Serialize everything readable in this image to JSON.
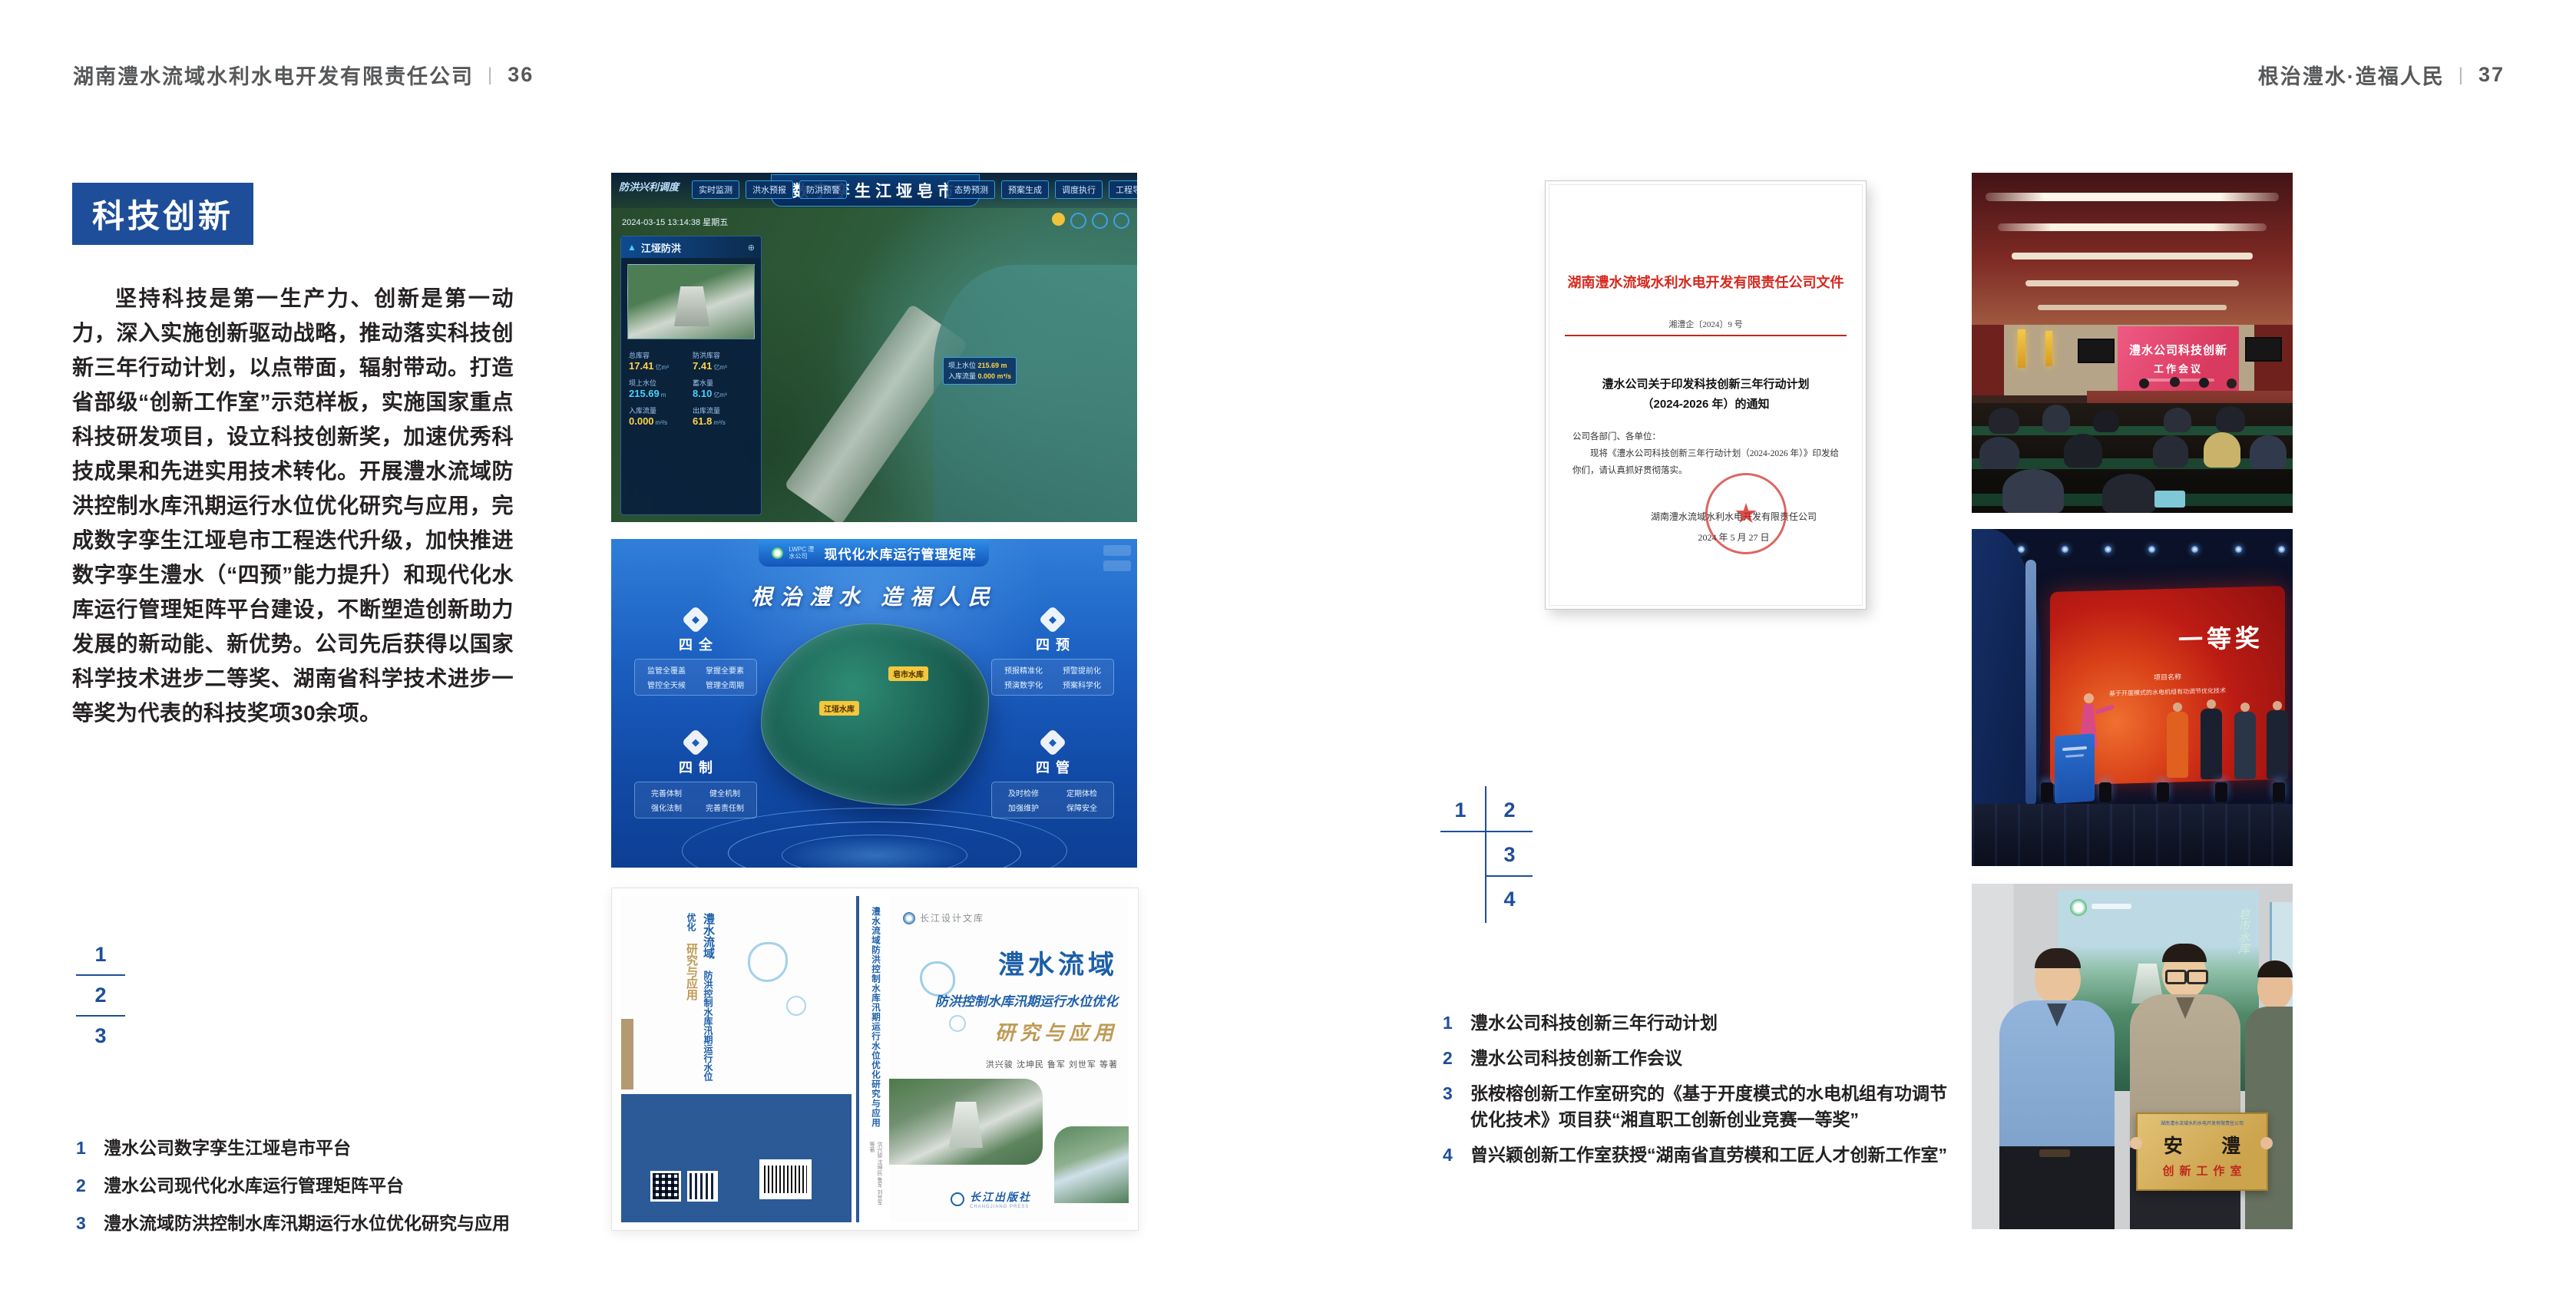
{
  "colors": {
    "accent_blue": "#1e4e9a",
    "doc_red": "#d5281e",
    "header_grey": "#57585a",
    "gold": "#bf9a55"
  },
  "page_left": {
    "header": "湖南澧水流域水利水电开发有限责任公司",
    "divider": "|",
    "page_no": "36",
    "section_title": "科技创新",
    "paragraph": "坚持科技是第一生产力、创新是第一动力，深入实施创新驱动战略，推动落实科技创新三年行动计划，以点带面，辐射带动。打造省部级“创新工作室”示范样板，实施国家重点科技研发项目，设立科技创新奖，加速优秀科技成果和先进实用技术转化。开展澧水流域防洪控制水库汛期运行水位优化研究与应用，完成数字孪生江垭皂市工程迭代升级，加快推进数字孪生澧水（“四预”能力提升）和现代化水库运行管理矩阵平台建设，不断塑造创新助力发展的新动能、新优势。公司先后获得以国家科学技术进步二等奖、湖南省科学技术进步一等奖为代表的科技奖项30余项。",
    "index_numbers": [
      "1",
      "2",
      "3"
    ],
    "captions": [
      {
        "num": "1",
        "text": "澧水公司数字孪生江垭皂市平台"
      },
      {
        "num": "2",
        "text": "澧水公司现代化水库运行管理矩阵平台"
      },
      {
        "num": "3",
        "text": "澧水流域防洪控制水库汛期运行水位优化研究与应用"
      }
    ]
  },
  "page_right": {
    "header": "根治澧水·造福人民",
    "divider": "|",
    "page_no": "37",
    "index_numbers": [
      "1",
      "2",
      "3",
      "4"
    ],
    "captions": [
      {
        "num": "1",
        "text": "澧水公司科技创新三年行动计划"
      },
      {
        "num": "2",
        "text": "澧水公司科技创新工作会议"
      },
      {
        "num": "3",
        "text": "张桉榕创新工作室研究的《基于开度模式的水电机组有功调节",
        "text2": "优化技术》项目获“湘直职工创新创业竞赛一等奖”"
      },
      {
        "num": "4",
        "text": "曾兴颖创新工作室获授“湖南省直劳模和工匠人才创新工作室”"
      }
    ]
  },
  "figures": {
    "dashboard": {
      "emblem": "防洪兴利调度",
      "title": "数字孪生江垭皂市",
      "tabs_left": [
        "实时监测",
        "洪水预报",
        "防洪预警"
      ],
      "tabs_right": [
        "态势预测",
        "预案生成",
        "调度执行",
        "工程导览"
      ],
      "timestamp": "2024-03-15 13:14:38 星期五",
      "panel_title": "江垭防洪",
      "stats": [
        {
          "label": "总库容",
          "value": "17.41",
          "unit": "亿m³"
        },
        {
          "label": "防洪库容",
          "value": "7.41",
          "unit": "亿m³"
        },
        {
          "label": "坝上水位",
          "value": "215.69",
          "unit": "m"
        },
        {
          "label": "蓄水量",
          "value": "8.10",
          "unit": "亿m³"
        },
        {
          "label": "入库流量",
          "value": "0.000",
          "unit": "m³/s"
        },
        {
          "label": "出库流量",
          "value": "61.8",
          "unit": "m³/s"
        }
      ],
      "tag1_label": "坝上水位",
      "tag1_value": "215.69 m",
      "tag2_label": "入库流量",
      "tag2_value": "0.000 m³/s"
    },
    "matrix": {
      "logo_text": "LWPC 澧水公司",
      "title": "现代化水库运行管理矩阵",
      "slogan": "根治澧水 造福人民",
      "groups": [
        {
          "label": "四全",
          "items": [
            "监管全覆盖",
            "掌握全要素",
            "管控全天候",
            "管理全周期"
          ]
        },
        {
          "label": "四预",
          "items": [
            "预报精准化",
            "预警提前化",
            "预演数字化",
            "预案科学化"
          ]
        },
        {
          "label": "四制",
          "items": [
            "完善体制",
            "健全机制",
            "强化法制",
            "完善责任制"
          ]
        },
        {
          "label": "四管",
          "items": [
            "及时检修",
            "定期体检",
            "加强维护",
            "保障安全"
          ]
        }
      ],
      "map_tag1": "皂市水库",
      "map_tag2": "江垭水库"
    },
    "book": {
      "series": "长江设计文库",
      "title_line1": "澧水流域",
      "title_line2": "防洪控制水库汛期运行水位优化",
      "title_line3": "研究与应用",
      "authors": "洪兴骏 沈坤民 鲁军 刘世军 等著",
      "spine_title": "澧水流域防洪控制水库汛期运行水位优化研究与应用",
      "publisher": "长江出版社",
      "publisher_en": "CHANGJIANG PRESS"
    },
    "document": {
      "header": "湖南澧水流域水利水电开发有限责任公司文件",
      "doc_no": "湘澧企〔2024〕9 号",
      "title_line1": "澧水公司关于印发科技创新三年行动计划",
      "title_line2": "（2024-2026 年）的通知",
      "salutation": "公司各部门、各单位：",
      "body": "现将《澧水公司科技创新三年行动计划（2024-2026 年）》印发给你们，请认真抓好贯彻落实。",
      "signature": "湖南澧水流域水利水电开发有限责任公司",
      "date": "2024 年 5 月 27 日",
      "stamp_star": "★"
    },
    "meeting": {
      "screen_line1": "澧水公司科技创新",
      "screen_line2": "工作会议"
    },
    "award": {
      "screen_title": "一等奖",
      "screen_sub1": "项目名称",
      "screen_sub2": "基于开度模式的水电机组有功调节优化技术"
    },
    "group": {
      "plaque_header": "湖南澧水流域水利水电开发有限责任公司",
      "plaque_title": "安 澧",
      "plaque_subtitle": "创新工作室",
      "poster_caption": "皂市水库"
    }
  }
}
